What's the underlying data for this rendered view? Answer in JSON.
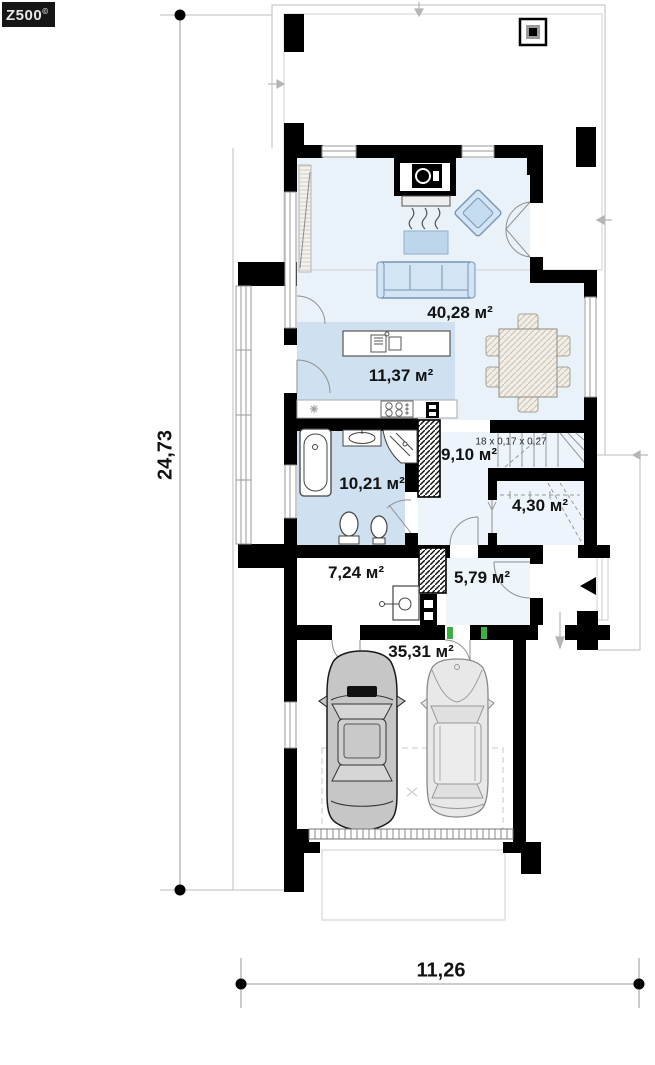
{
  "logo": {
    "text": "Z500",
    "mark": "©"
  },
  "dimensions": {
    "total_depth": "24,73",
    "total_width": "11,26"
  },
  "rooms": {
    "living_dining": {
      "area": "40,28 м²"
    },
    "kitchen": {
      "area": "11,37 м²"
    },
    "hall": {
      "area": "9,10 м²"
    },
    "bathroom": {
      "area": "10,21 м²"
    },
    "storage_under_stairs": {
      "area": "4,30 м²"
    },
    "utility": {
      "area": "7,24 м²"
    },
    "entry": {
      "area": "5,79 м²"
    },
    "garage": {
      "area": "35,31 м²"
    }
  },
  "annotations": {
    "stairs_spec": "18 x 0,17 x 0,27"
  },
  "colors": {
    "wall": "#000000",
    "floor_light": "#e9f1f9",
    "floor_blue": "#cfe1f1",
    "furniture_blue": "#d3e5f4",
    "threshold_green": "#3cb043"
  }
}
